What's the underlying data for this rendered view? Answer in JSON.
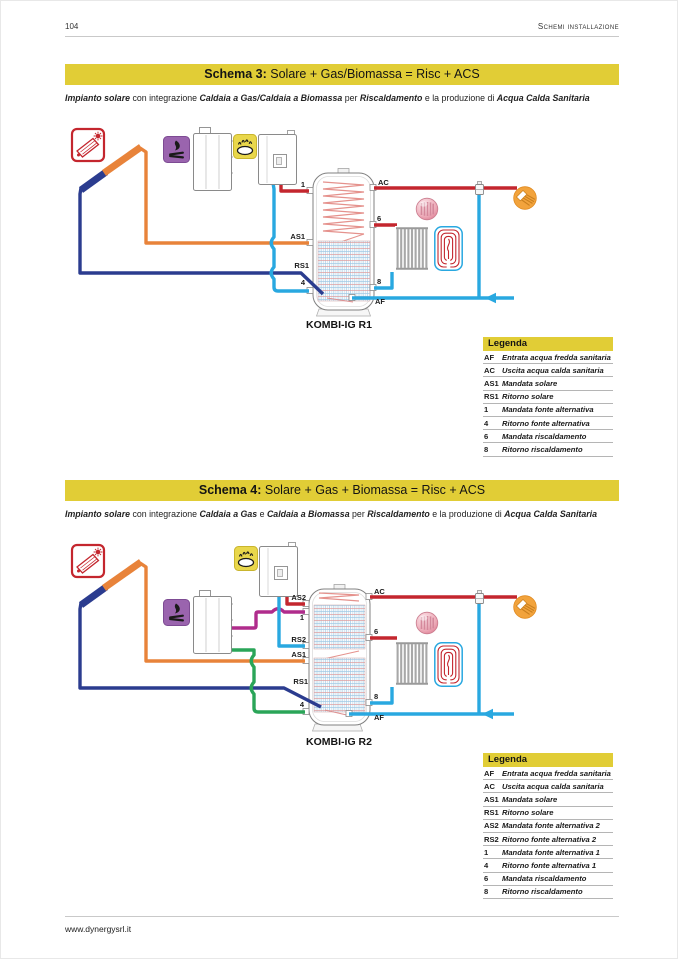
{
  "page": {
    "number": "104",
    "section": "Schemi installazione",
    "footer_url": "www.dynergysrl.it"
  },
  "palette": {
    "accent_yellow": "#e1cd36",
    "pipe_hot_red": "#c4262e",
    "pipe_solar_supply_orange": "#e8833a",
    "pipe_solar_return_navy": "#2b3c8f",
    "pipe_cold_lightblue": "#29a8e0",
    "pipe_biomass_supply_magenta": "#b02c8c",
    "pipe_biomass_return_green": "#2aa558"
  },
  "icons": {
    "solar": "solar-collector-icon",
    "biomass": "biomass-flame-icon",
    "gas": "gas-burner-icon",
    "radiator_photo": "radiator-photo-icon",
    "floor_heating": "floor-heating-loop-icon",
    "shower": "hot-water-tap-icon",
    "valve": "mixing-valve-icon",
    "flow_arrow": "cold-water-inlet-arrow"
  },
  "schemas": [
    {
      "title_label": "Schema 3:",
      "title_text": " Solare + Gas/Biomassa = Risc + ACS",
      "subtitle_segments": [
        {
          "text": "Impianto solare",
          "bold": true
        },
        {
          "text": " con integrazione ",
          "bold": false
        },
        {
          "text": "Caldaia a Gas/Caldaia a Biomassa",
          "bold": true
        },
        {
          "text": " per ",
          "bold": false
        },
        {
          "text": "Riscaldamento",
          "bold": true
        },
        {
          "text": " e la produzione di ",
          "bold": false
        },
        {
          "text": "Acqua Calda Sanitaria",
          "bold": true
        }
      ],
      "product": "KOMBI-IG R1",
      "ports": {
        "p1": "1",
        "p4": "4",
        "p6": "6",
        "p8": "8",
        "ac": "AC",
        "af": "AF",
        "as1": "AS1",
        "rs1": "RS1"
      },
      "legend": {
        "title": "Legenda",
        "rows": [
          {
            "code": "AF",
            "desc": "Entrata acqua fredda sanitaria"
          },
          {
            "code": "AC",
            "desc": "Uscita acqua calda sanitaria"
          },
          {
            "code": "AS1",
            "desc": "Mandata solare"
          },
          {
            "code": "RS1",
            "desc": "Ritorno solare"
          },
          {
            "code": "1",
            "desc": "Mandata fonte alternativa"
          },
          {
            "code": "4",
            "desc": "Ritorno fonte alternativa"
          },
          {
            "code": "6",
            "desc": "Mandata riscaldamento"
          },
          {
            "code": "8",
            "desc": "Ritorno riscaldamento"
          }
        ]
      }
    },
    {
      "title_label": "Schema 4:",
      "title_text": " Solare + Gas + Biomassa = Risc + ACS",
      "subtitle_segments": [
        {
          "text": "Impianto solare",
          "bold": true
        },
        {
          "text": " con integrazione ",
          "bold": false
        },
        {
          "text": "Caldaia a Gas",
          "bold": true
        },
        {
          "text": " e ",
          "bold": false
        },
        {
          "text": "Caldaia a Biomassa",
          "bold": true
        },
        {
          "text": " per ",
          "bold": false
        },
        {
          "text": "Riscaldamento",
          "bold": true
        },
        {
          "text": " e la produzione di ",
          "bold": false
        },
        {
          "text": "Acqua Calda Sanitaria",
          "bold": true
        }
      ],
      "product": "KOMBI-IG R2",
      "ports": {
        "p1": "1",
        "p4": "4",
        "p6": "6",
        "p8": "8",
        "ac": "AC",
        "af": "AF",
        "as1": "AS1",
        "rs1": "RS1",
        "as2": "AS2",
        "rs2": "RS2"
      },
      "legend": {
        "title": "Legenda",
        "rows": [
          {
            "code": "AF",
            "desc": "Entrata acqua fredda sanitaria"
          },
          {
            "code": "AC",
            "desc": "Uscita acqua calda sanitaria"
          },
          {
            "code": "AS1",
            "desc": "Mandata solare"
          },
          {
            "code": "RS1",
            "desc": "Ritorno solare"
          },
          {
            "code": "AS2",
            "desc": "Mandata fonte alternativa 2"
          },
          {
            "code": "RS2",
            "desc": "Ritorno fonte alternativa 2"
          },
          {
            "code": "1",
            "desc": "Mandata fonte alternativa 1"
          },
          {
            "code": "4",
            "desc": "Ritorno fonte alternativa 1"
          },
          {
            "code": "6",
            "desc": "Mandata riscaldamento"
          },
          {
            "code": "8",
            "desc": "Ritorno riscaldamento"
          }
        ]
      }
    }
  ]
}
